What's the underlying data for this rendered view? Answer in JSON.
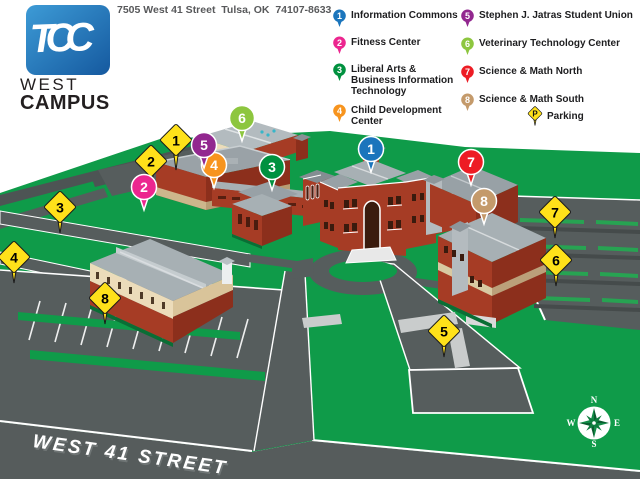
{
  "colors": {
    "brand_blue": "#1b75bc",
    "field_green": "#0f9b49",
    "road_gray": "#575d5d",
    "brick_red": "#a63c25",
    "roof_gray": "#9aa2a7",
    "parking_yellow": "#ffe11a"
  },
  "header": {
    "logo_text": "TCC",
    "campus_word1": "WEST",
    "campus_word2": "CAMPUS",
    "address": "7505 West 41 Street  Tulsa, OK  74107-8633"
  },
  "legend": {
    "column1": [
      {
        "num": "1",
        "color": "#1b75bc",
        "label": "Information Commons"
      },
      {
        "num": "2",
        "color": "#ec268f",
        "label": "Fitness Center"
      },
      {
        "num": "3",
        "color": "#00913f",
        "label": "Liberal Arts & Business Information Technology"
      },
      {
        "num": "4",
        "color": "#f7941e",
        "label": "Child Development Center"
      }
    ],
    "column2": [
      {
        "num": "5",
        "color": "#92278f",
        "label": "Stephen J. Jatras Student Union"
      },
      {
        "num": "6",
        "color": "#8dc63f",
        "label": "Veterinary Technology Center"
      },
      {
        "num": "7",
        "color": "#ed1c24",
        "label": "Science & Math North"
      },
      {
        "num": "8",
        "color": "#c49a6b",
        "label": "Science & Math South"
      }
    ],
    "parking": {
      "symbol": "P",
      "label": "Parking",
      "color": "#ffe11a"
    }
  },
  "map": {
    "street_label": "WEST 41 STREET",
    "building_markers": [
      {
        "num": "1",
        "color": "#1b75bc"
      },
      {
        "num": "2",
        "color": "#ec268f"
      },
      {
        "num": "3",
        "color": "#00913f"
      },
      {
        "num": "4",
        "color": "#f7941e"
      },
      {
        "num": "5",
        "color": "#92278f"
      },
      {
        "num": "6",
        "color": "#8dc63f"
      },
      {
        "num": "7",
        "color": "#ed1c24"
      },
      {
        "num": "8",
        "color": "#c49a6b"
      }
    ],
    "parking_markers": [
      {
        "num": "1"
      },
      {
        "num": "2"
      },
      {
        "num": "3"
      },
      {
        "num": "4"
      },
      {
        "num": "5"
      },
      {
        "num": "6"
      },
      {
        "num": "7"
      },
      {
        "num": "8"
      }
    ],
    "compass": {
      "n": "N",
      "e": "E",
      "s": "S",
      "w": "W"
    }
  }
}
